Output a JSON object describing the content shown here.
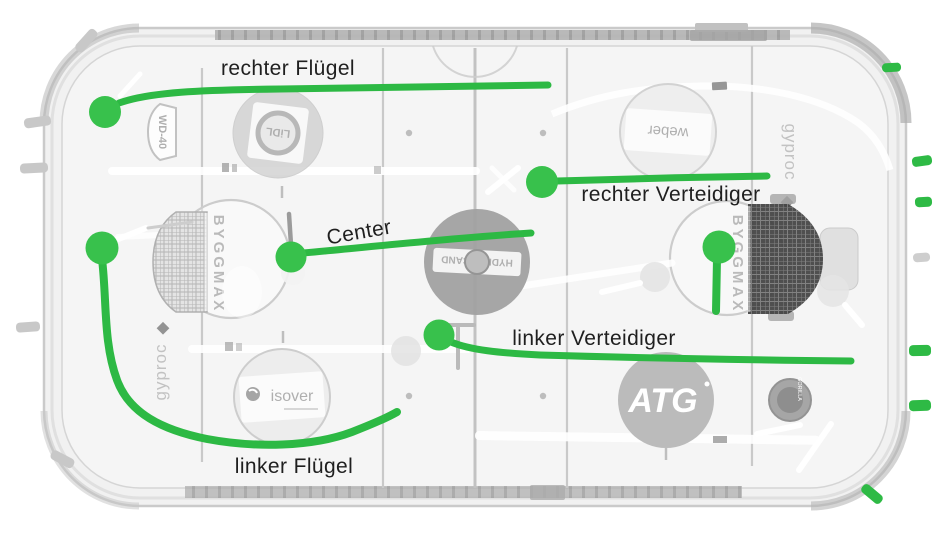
{
  "diagram": {
    "positions": [
      {
        "id": "right-wing",
        "label": "rechter Flügel"
      },
      {
        "id": "center",
        "label": "Center"
      },
      {
        "id": "right-defender",
        "label": "rechter Verteidiger"
      },
      {
        "id": "left-defender",
        "label": "linker Verteidiger"
      },
      {
        "id": "left-wing",
        "label": "linker Flügel"
      }
    ],
    "colors": {
      "annotation_green": "#2db944",
      "dot_green": "#38c14c",
      "label_text": "#1f1f1f"
    }
  },
  "rink": {
    "sponsors": {
      "wd40": "WD-40",
      "lidl": "LiDL",
      "byggmax": "BYGGMAX",
      "gyproc": "gyproc",
      "weber": "weber",
      "isover": "isover",
      "hydroscand": "HYDROSCAND",
      "atg": "ATG",
      "gorilla": "GORILLA"
    }
  }
}
